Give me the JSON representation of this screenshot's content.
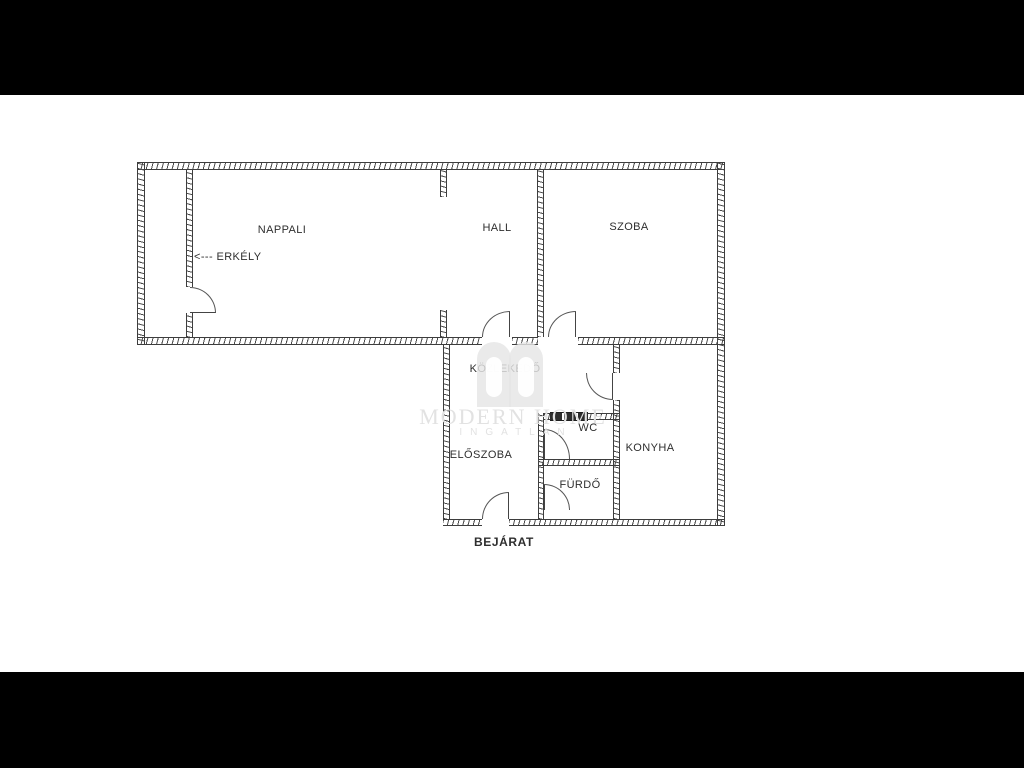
{
  "rooms": {
    "nappali": "NAPPALI",
    "hall": "HALL",
    "szoba": "SZOBA",
    "erkely": "<--- ERKÉLY",
    "kozlekedo": "KÖZLEKEDŐ",
    "eloszoba": "ELŐSZOBA",
    "wc": "WC",
    "furdo": "FÜRDŐ",
    "konyha": "KONYHA",
    "bejarat": "BEJÁRAT"
  },
  "watermark": {
    "brand": "MODERN HOME",
    "tagline": "INGATLAN"
  },
  "colors": {
    "wall": "#3d3d3d",
    "label": "#2e2e2e",
    "watermark": "#e2e2e2",
    "letterbox": "#000000",
    "paper": "#ffffff"
  }
}
